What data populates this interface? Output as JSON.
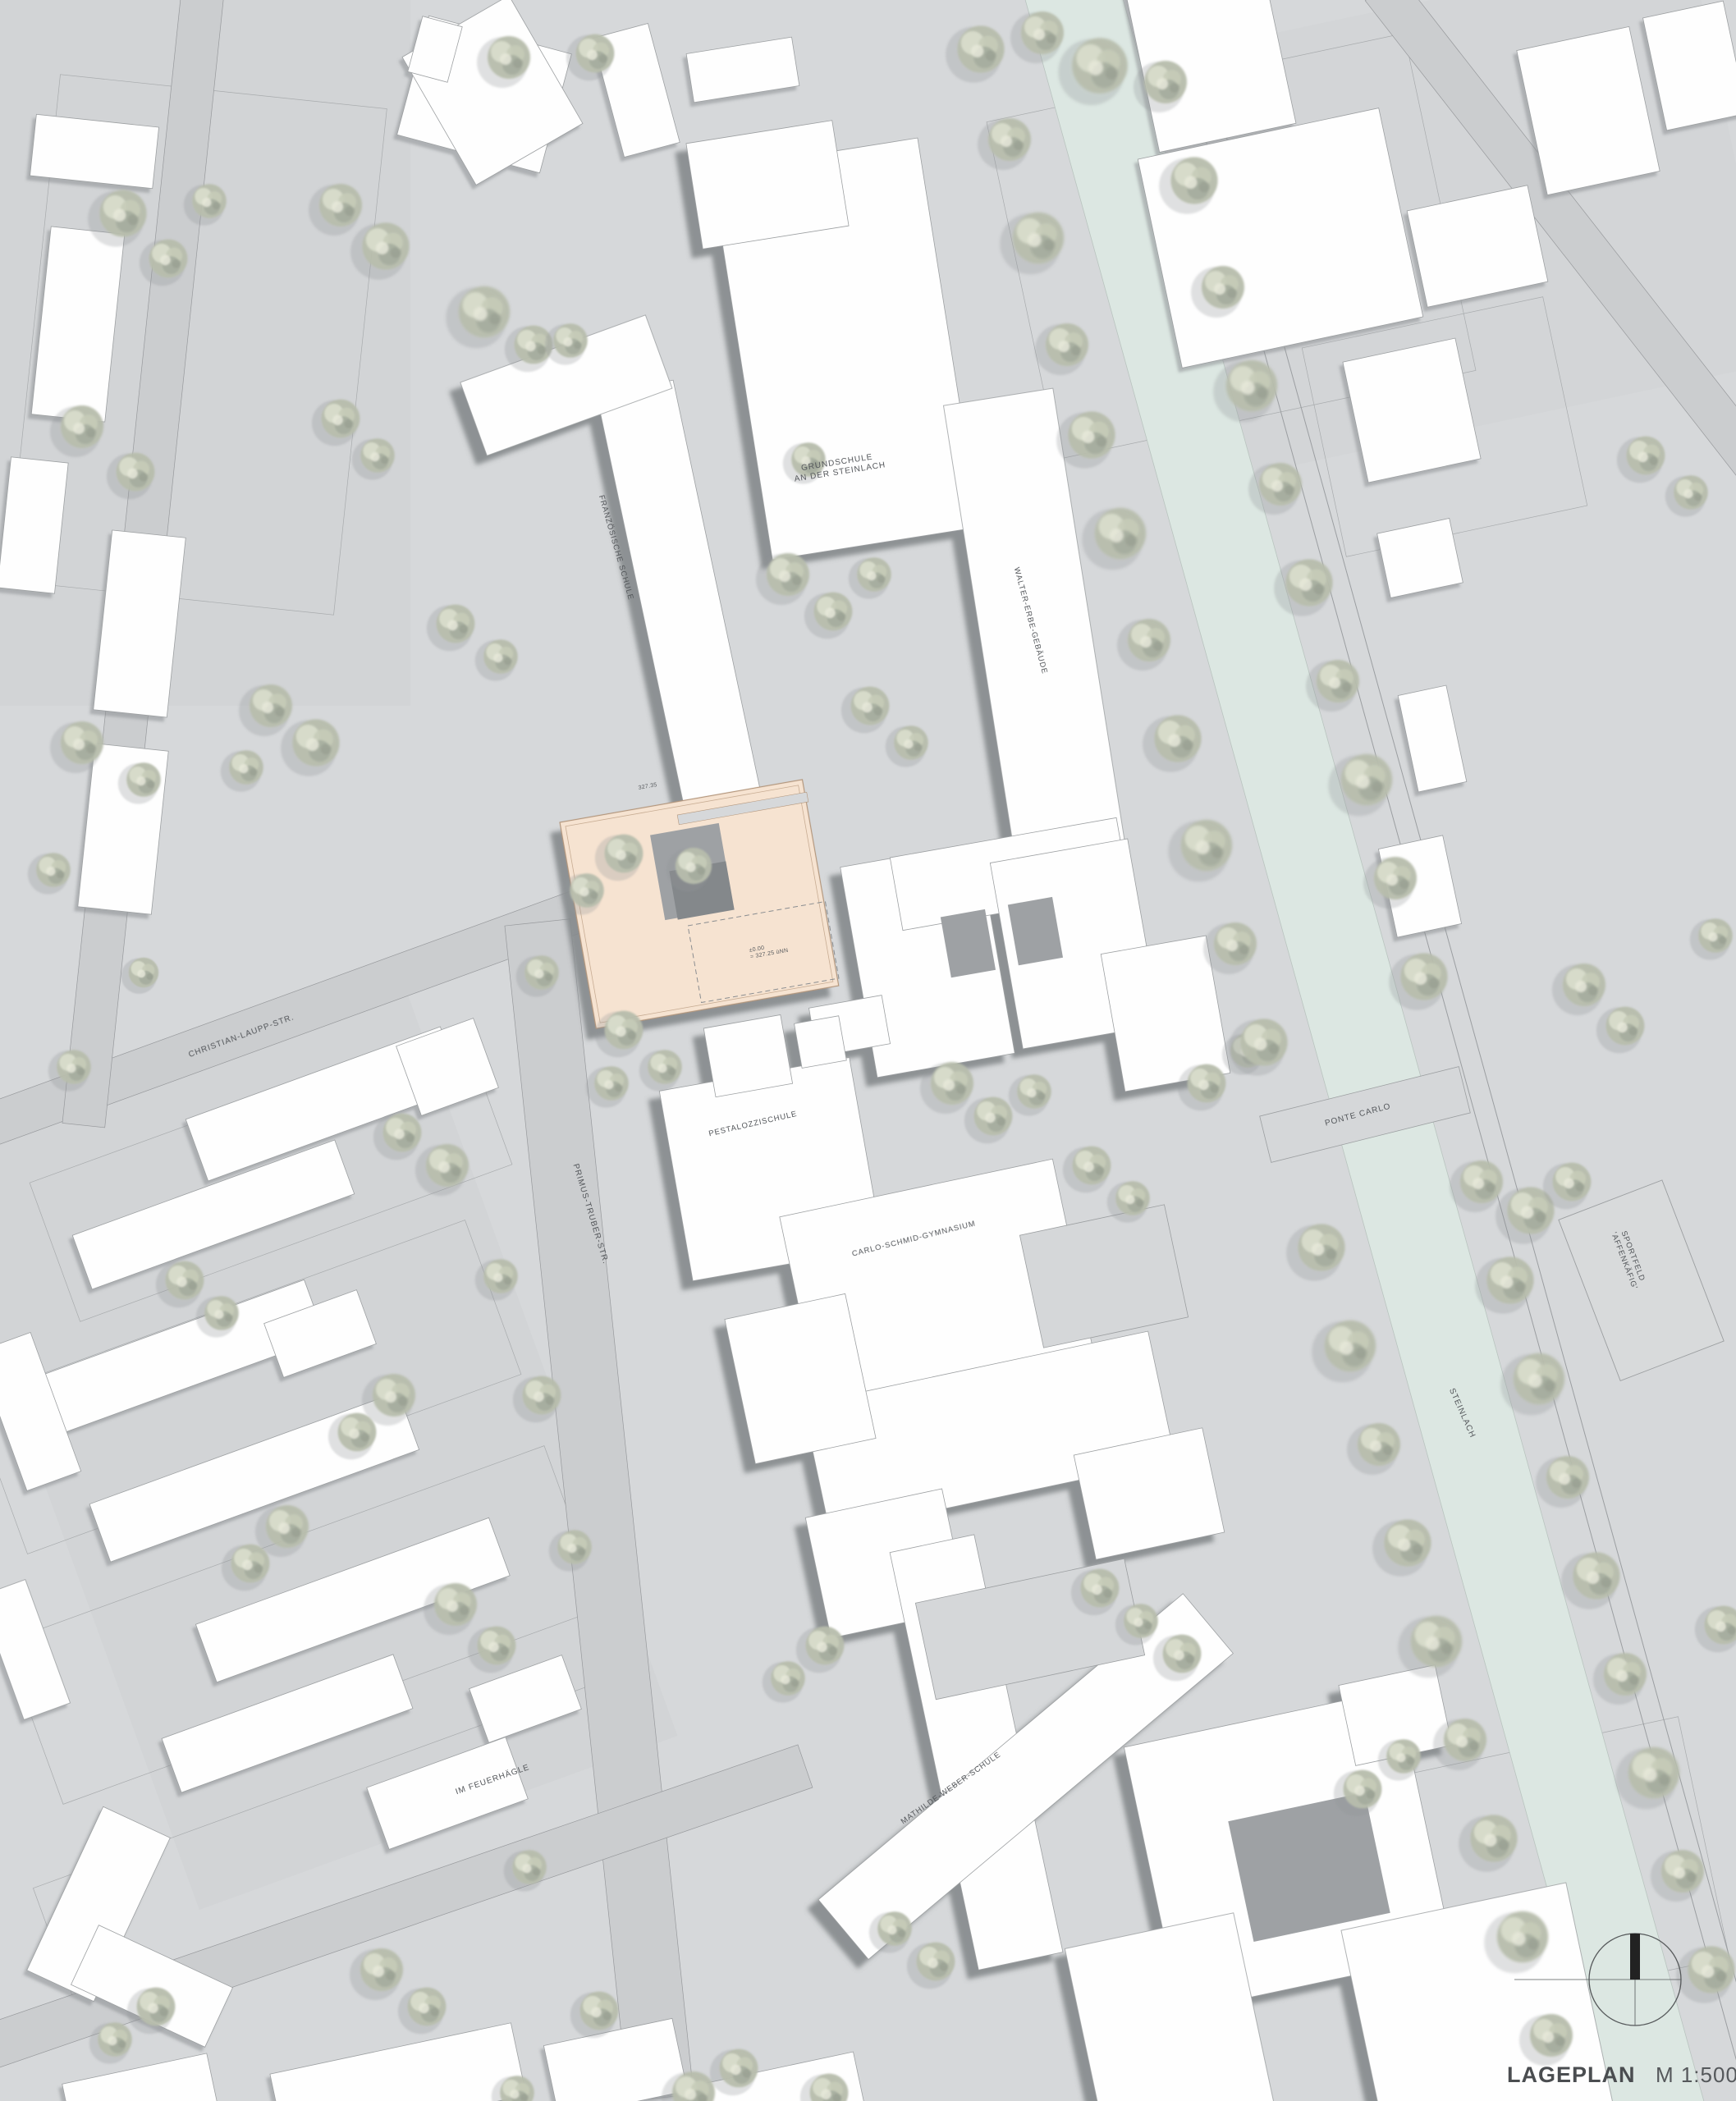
{
  "title": {
    "label": "LAGEPLAN",
    "scale": "M 1:500"
  },
  "labels": {
    "grundschule_line1": "GRUNDSCHULE",
    "grundschule_line2": "AN DER STEINLACH",
    "franzoesische_schule": "FRANZÖSISCHE SCHULE",
    "walter_erbe": "WALTER-ERBE-GEBÄUDE",
    "pestalozzischule": "PESTALOZZISCHULE",
    "carlo_schmid": "CARLO-SCHMID-GYMNASIUM",
    "mathilde_weber": "MATHILDE-WEBER-SCHULE",
    "christian_laupp": "CHRISTIAN-LAUPP-STR.",
    "primus_truber": "PRIMUS-TRUBER-STR.",
    "im_feuerhaegle": "IM FEUERHÄGLE",
    "ponte_carlo": "PONTE CARLO",
    "steinlach": "STEINLACH",
    "sportfeld_line1": "SPORTFELD",
    "sportfeld_line2": "'AFFENKÄFIG'"
  },
  "annotations": {
    "elev_top": "327.35",
    "elev_zero_line1": "±0.00",
    "elev_zero_line2": "= 327.25 üNN"
  },
  "colors": {
    "background": "#d6d8da",
    "street": "#cbcdcf",
    "building": "#fefefe",
    "shadow": "#85898c",
    "river": "#dce7e2",
    "highlight_building": "#f6e3d1",
    "highlight_outline": "#b3967c",
    "tree": "#b7bdac",
    "label_text": "#54575a"
  }
}
